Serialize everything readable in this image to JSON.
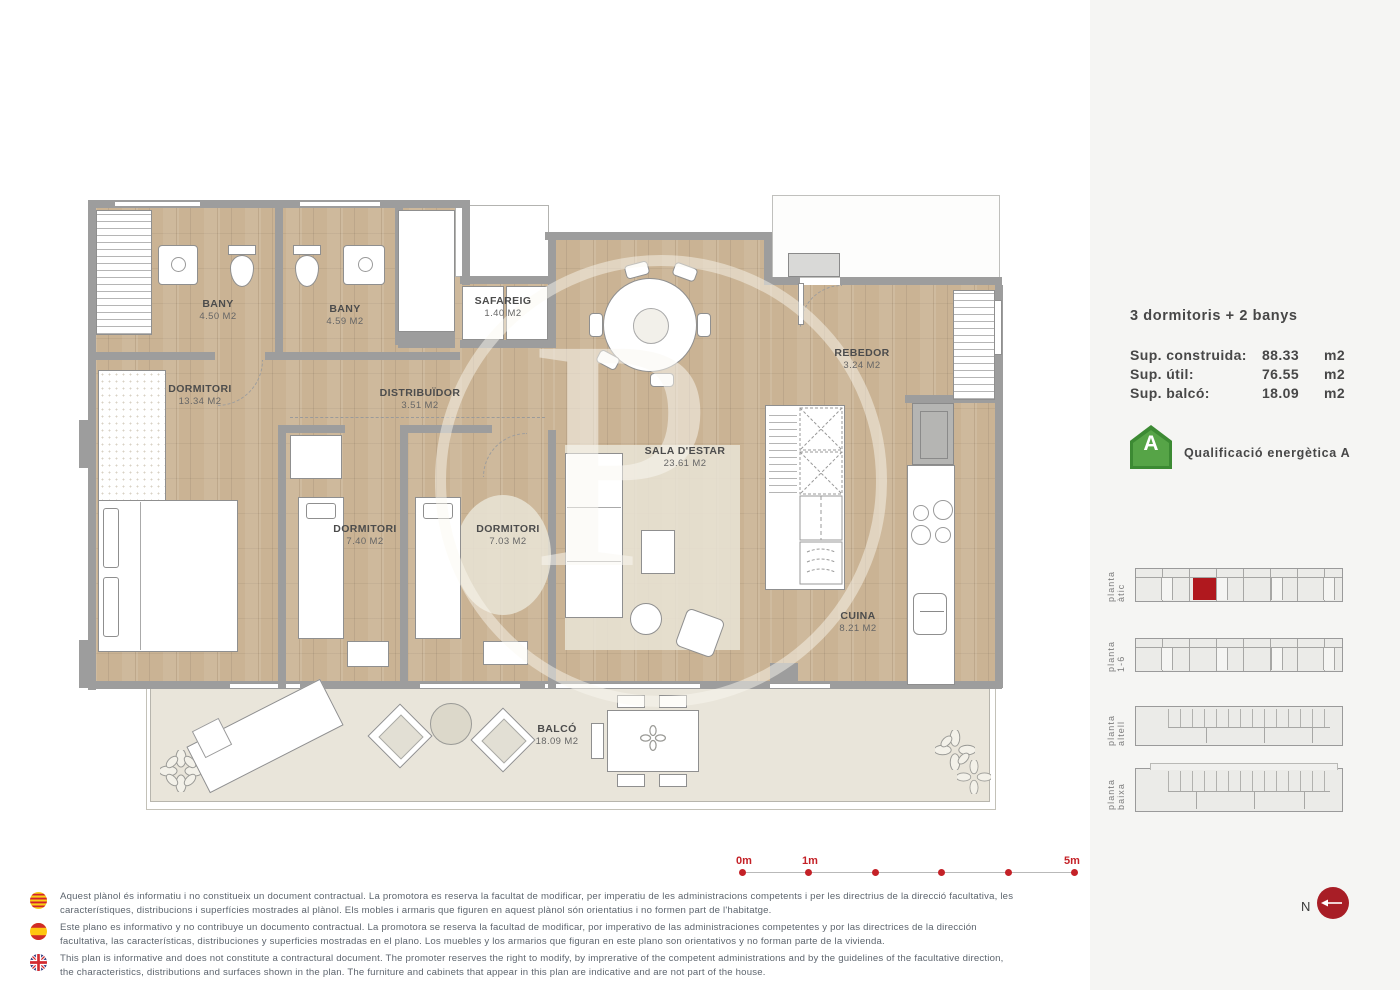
{
  "plan": {
    "watermark": "P",
    "rooms": [
      {
        "name": "BANY",
        "area": "4.50 M2"
      },
      {
        "name": "BANY",
        "area": "4.59 M2"
      },
      {
        "name": "SAFAREIG",
        "area": "1.40 M2"
      },
      {
        "name": "DORMITORI",
        "area": "13.34 M2"
      },
      {
        "name": "DISTRIBUÏDOR",
        "area": "3.51 M2"
      },
      {
        "name": "REBEDOR",
        "area": "3.24 M2"
      },
      {
        "name": "SALA D'ESTAR",
        "area": "23.61 M2"
      },
      {
        "name": "DORMITORI",
        "area": "7.40 M2"
      },
      {
        "name": "DORMITORI",
        "area": "7.03 M2"
      },
      {
        "name": "CUINA",
        "area": "8.21 M2"
      },
      {
        "name": "BALCÓ",
        "area": "18.09 M2"
      }
    ]
  },
  "sidebar": {
    "title": "3 dormitoris + 2 banys",
    "surfaces": [
      {
        "label": "Sup. construida:",
        "value": "88.33",
        "unit": "m2"
      },
      {
        "label": "Sup. útil:",
        "value": "76.55",
        "unit": "m2"
      },
      {
        "label": "Sup. balcó:",
        "value": "18.09",
        "unit": "m2"
      }
    ],
    "energy": {
      "letter": "A",
      "label": "Qualificació energètica A",
      "color": "#56a447"
    },
    "levels": [
      {
        "label": "planta àtic",
        "highlight": true
      },
      {
        "label": "planta 1-6",
        "highlight": false
      },
      {
        "label": "planta altell",
        "highlight": false
      },
      {
        "label": "planta baixa",
        "highlight": false
      }
    ]
  },
  "scalebar": {
    "labels": [
      "0m",
      "1m",
      "5m"
    ],
    "color": "#c42127"
  },
  "north": {
    "label": "N"
  },
  "disclaimers": [
    {
      "lang": "ca",
      "text": "Aquest plànol és informatiu i no constitueix un document contractual. La promotora es reserva la facultat de modificar, per imperatiu de les administracions competents i per les directrius de la direcció facultativa, les característiques, distribucions i superfícies mostrades al plànol. Els mobles i armaris que figuren en aquest plànol són orientatius i no formen part de l'habitatge."
    },
    {
      "lang": "es",
      "text": "Este plano es informativo y no contribuye un documento contractual. La promotora se reserva la facultad de modificar, por imperativo de las administraciones competentes y por las directrices de la dirección facultativa, las características, distribuciones y superficies mostradas en el plano. Los muebles y los armarios que figuran en este plano son orientativos y no forman parte de la vivienda."
    },
    {
      "lang": "en",
      "text": "This plan is informative and does not constitute a contractural document. The promoter reserves the right to modify, by imprerative of the competent administrations and by the guidelines of the facultative direction, the characteristics, distributions and surfaces shown in the plan. The furniture and cabinets that appear in this plan are indicative and are not part of the house."
    }
  ]
}
